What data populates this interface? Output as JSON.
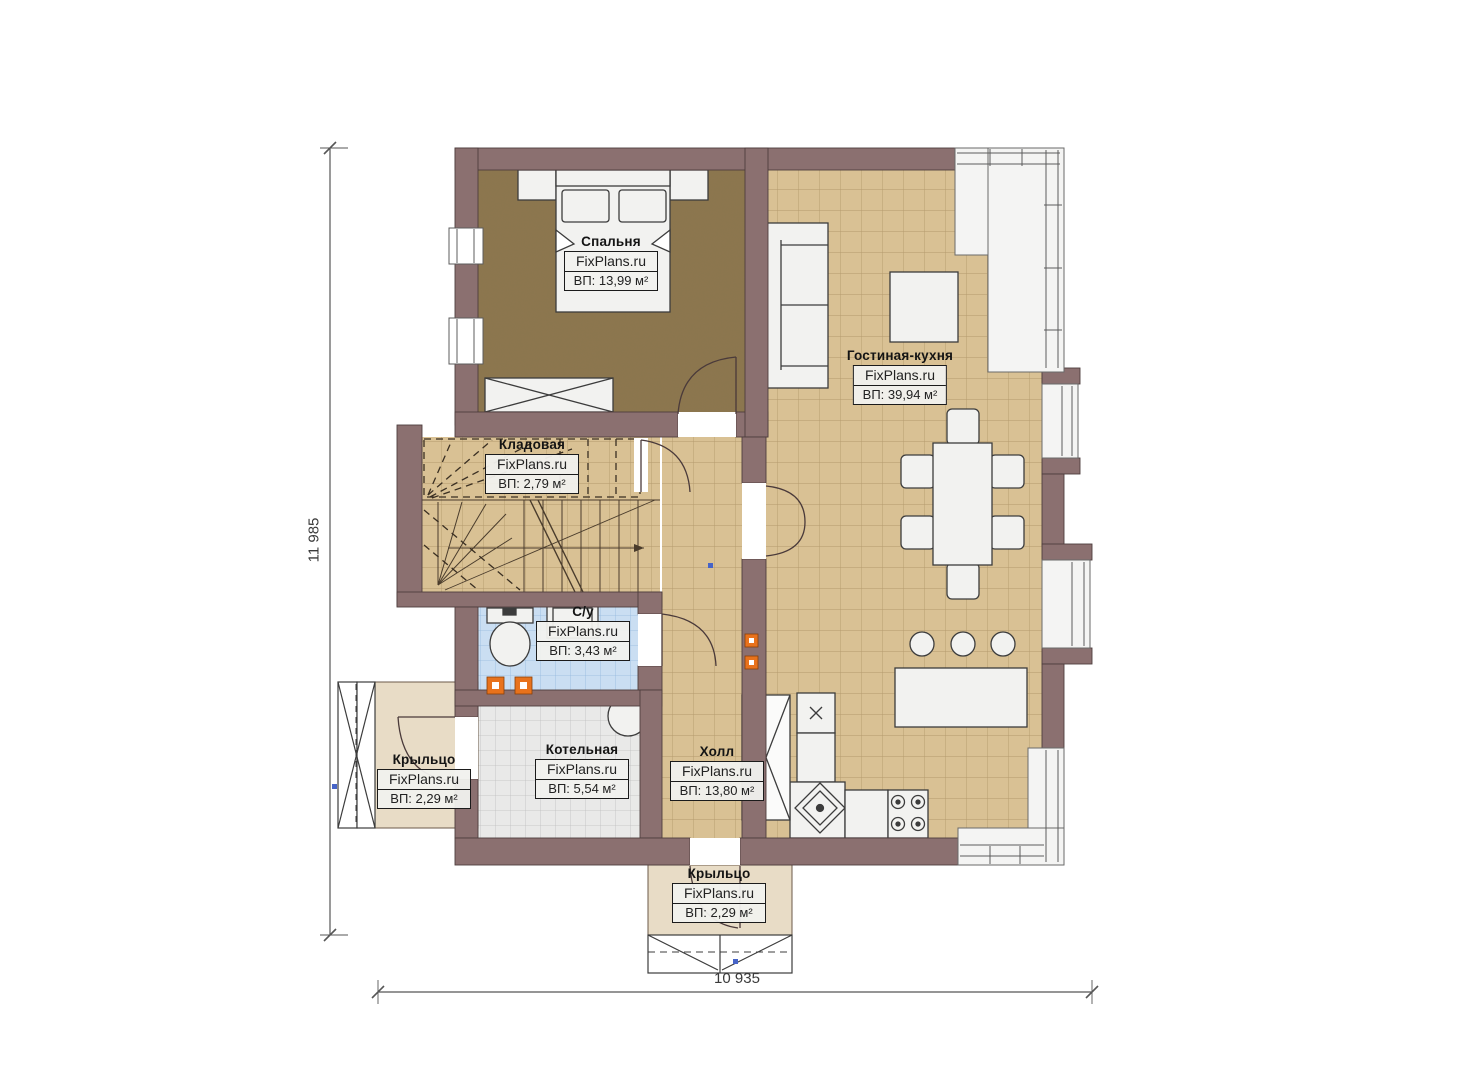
{
  "plan": {
    "brand": "FixPlans.ru",
    "rooms": [
      {
        "id": "bedroom",
        "name": "Спальня",
        "area": "ВП: 13,99 м²"
      },
      {
        "id": "living-kitchen",
        "name": "Гостиная-кухня",
        "area": "ВП: 39,94 м²"
      },
      {
        "id": "storage",
        "name": "Кладовая",
        "area": "ВП: 2,79 м²"
      },
      {
        "id": "bathroom",
        "name": "С/у",
        "area": "ВП: 3,43 м²"
      },
      {
        "id": "boiler",
        "name": "Котельная",
        "area": "ВП: 5,54 м²"
      },
      {
        "id": "hall",
        "name": "Холл",
        "area": "ВП: 13,80 м²"
      },
      {
        "id": "porch-left",
        "name": "Крыльцо",
        "area": "ВП: 2,29 м²"
      },
      {
        "id": "porch-bottom",
        "name": "Крыльцо",
        "area": "ВП: 2,29 м²"
      }
    ],
    "dimensions": {
      "vertical": "11 985",
      "horizontal": "10 935"
    },
    "colors": {
      "wall": "#8b7070",
      "bedroom_floor": "#8c764e",
      "tile_floor": "#d9c194",
      "bath_floor": "#cadef2",
      "boiler_floor": "#e8e8e7",
      "porch_floor": "#e8dcc6",
      "accent_marker": "#e8721c"
    }
  }
}
